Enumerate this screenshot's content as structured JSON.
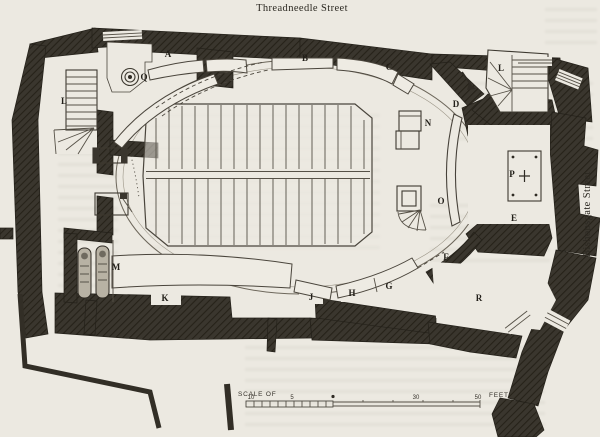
{
  "streets": {
    "top": "Threadneedle Street",
    "right": "Bishopsgate Street"
  },
  "letters": [
    {
      "text": "A",
      "x": 168,
      "y": 57
    },
    {
      "text": "B",
      "x": 305,
      "y": 61
    },
    {
      "text": "C",
      "x": 389,
      "y": 70
    },
    {
      "text": "D",
      "x": 456,
      "y": 107
    },
    {
      "text": "E",
      "x": 514,
      "y": 221
    },
    {
      "text": "F",
      "x": 446,
      "y": 260
    },
    {
      "text": "G",
      "x": 389,
      "y": 289
    },
    {
      "text": "H",
      "x": 352,
      "y": 296
    },
    {
      "text": "J",
      "x": 311,
      "y": 300
    },
    {
      "text": "K",
      "x": 165,
      "y": 301
    },
    {
      "text": "L",
      "x": 64,
      "y": 104
    },
    {
      "text": "L",
      "x": 501,
      "y": 71
    },
    {
      "text": "M",
      "x": 116,
      "y": 270
    },
    {
      "text": "N",
      "x": 428,
      "y": 126
    },
    {
      "text": "O",
      "x": 441,
      "y": 204
    },
    {
      "text": "P",
      "x": 512,
      "y": 177
    },
    {
      "text": "Q",
      "x": 144,
      "y": 80
    },
    {
      "text": "R",
      "x": 479,
      "y": 301
    }
  ],
  "scale": {
    "prefix": "SCALE OF",
    "unit": "FEET",
    "ticks": [
      {
        "text": "10",
        "x": 251
      },
      {
        "text": "5",
        "x": 292
      },
      {
        "text": "30",
        "x": 416
      },
      {
        "text": "50",
        "x": 478
      }
    ]
  },
  "colors": {
    "paper": "#ece9e1",
    "ink": "#24211a",
    "wall": "#3a362e"
  }
}
